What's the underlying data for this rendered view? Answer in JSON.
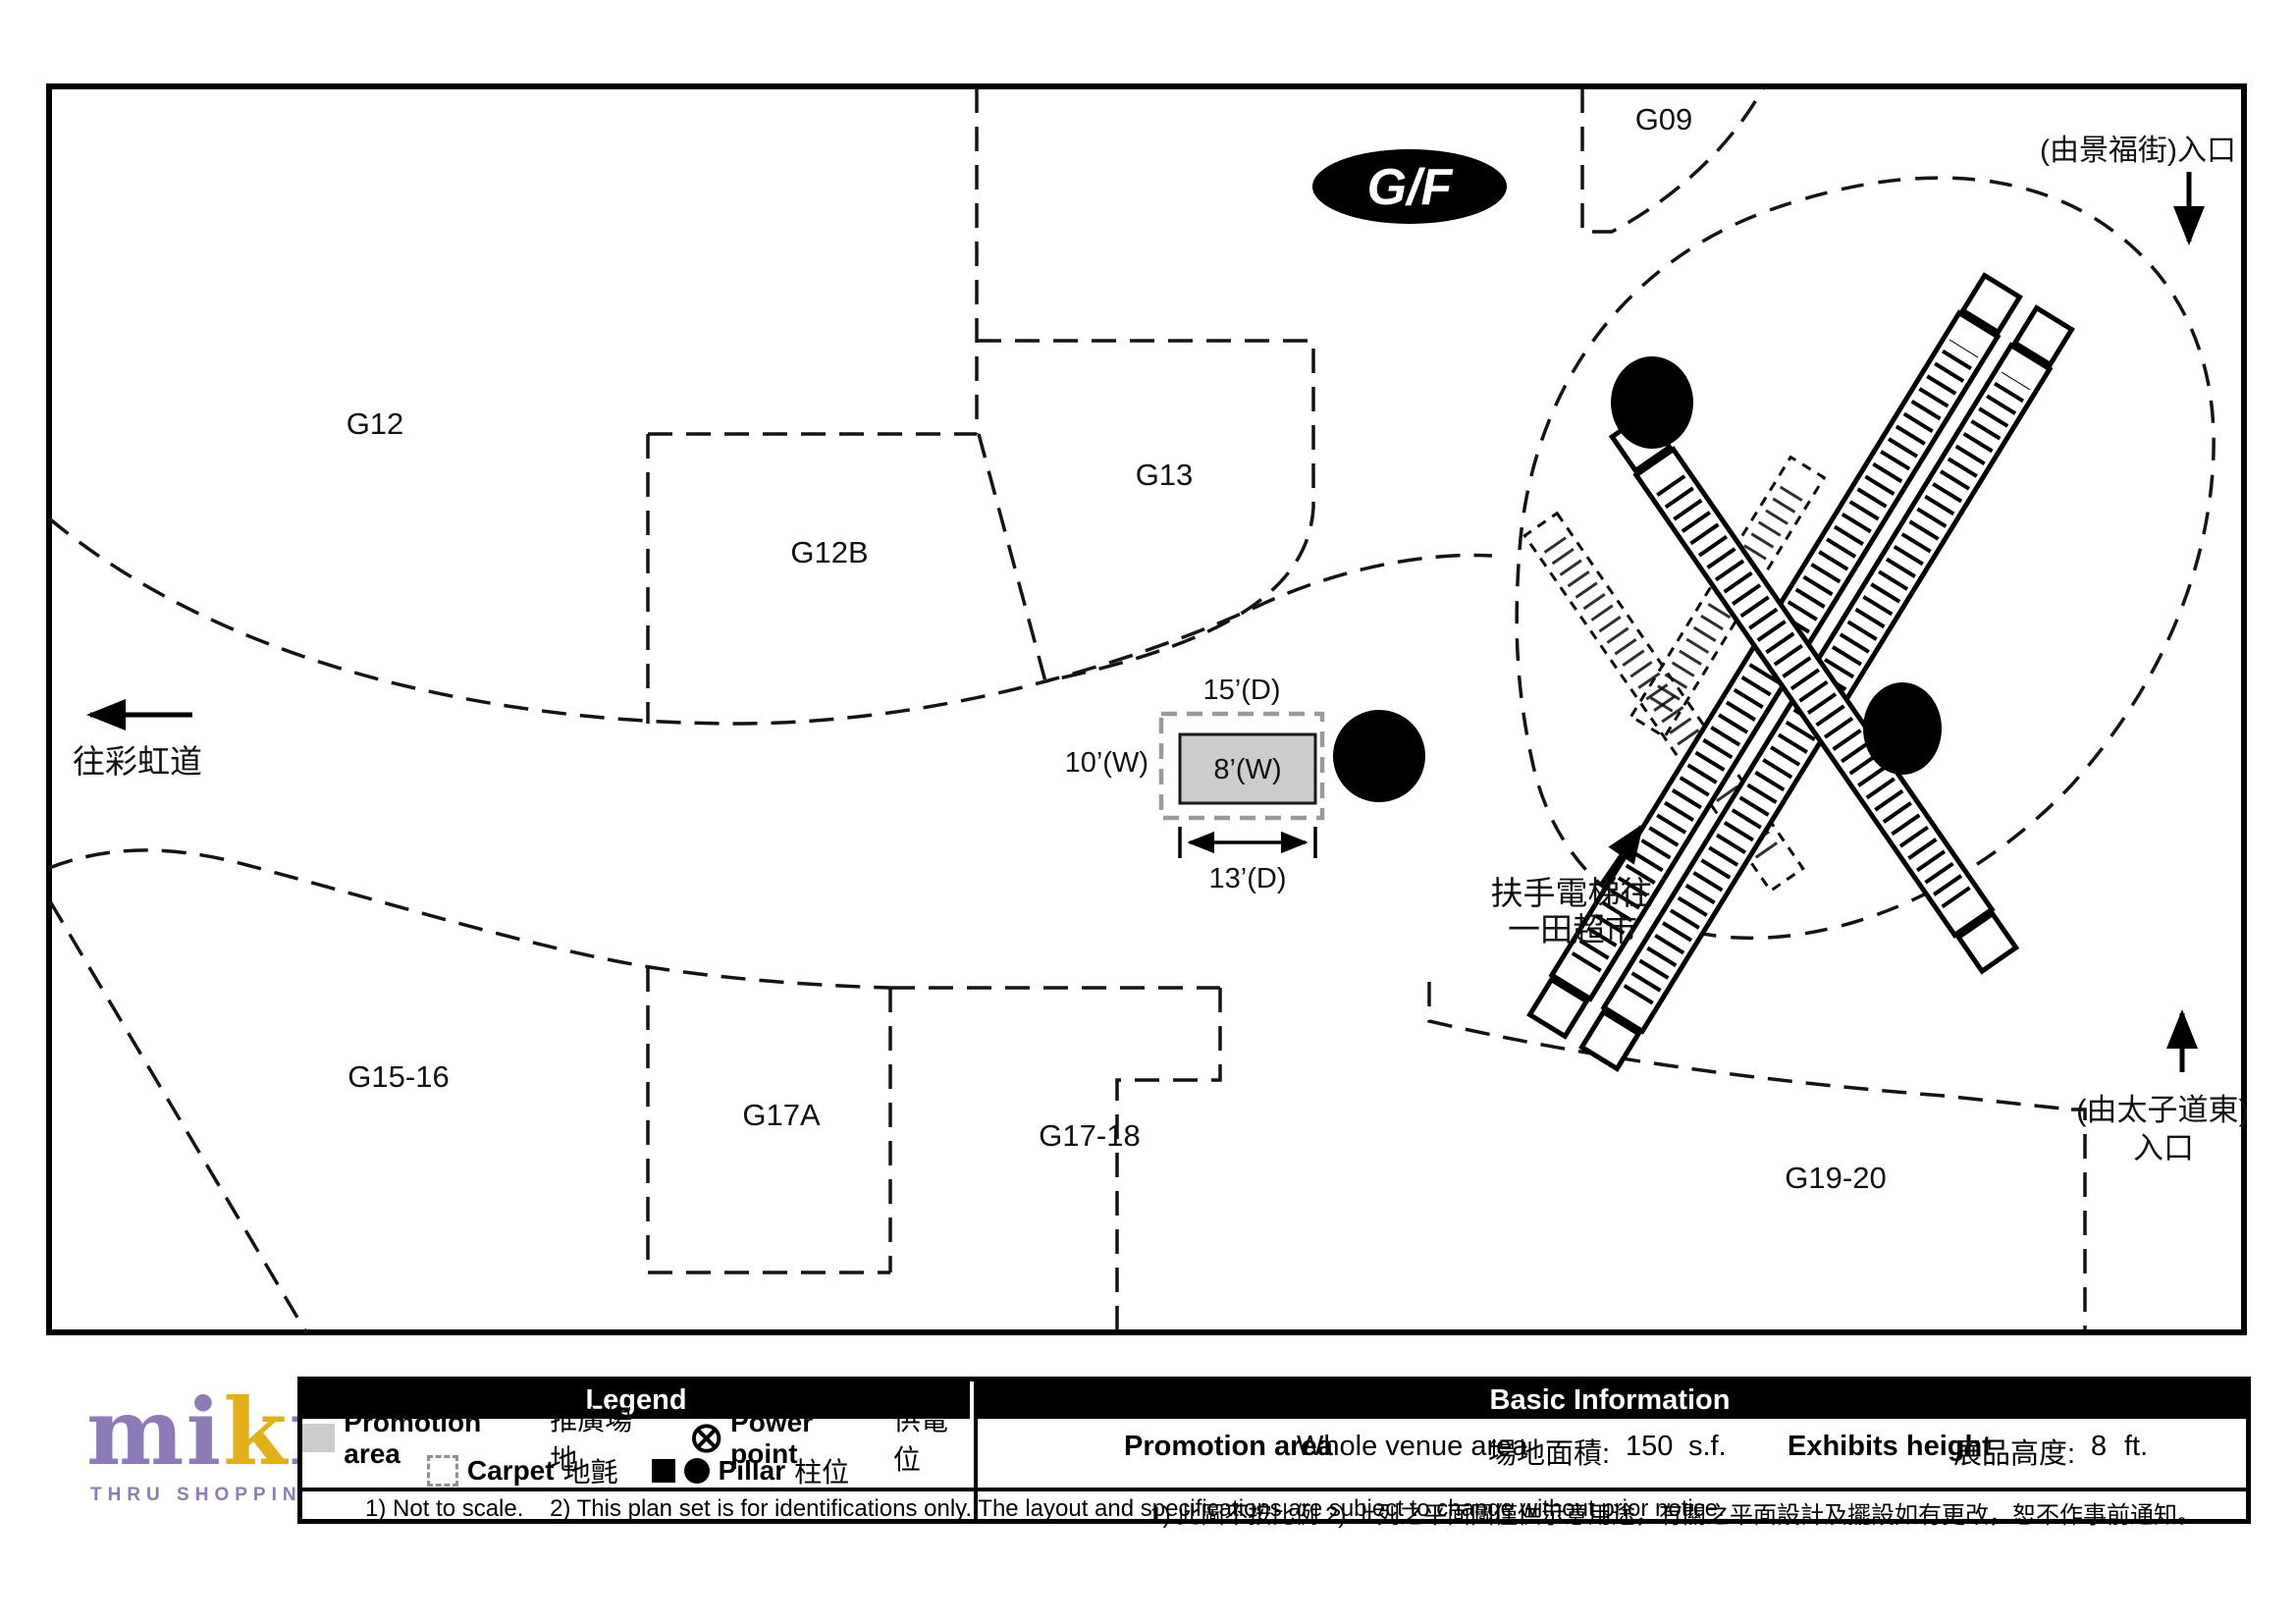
{
  "floor_badge": "G/F",
  "shops": {
    "g09": "G09",
    "g12": "G12",
    "g12b": "G12B",
    "g13": "G13",
    "g15_16": "G15-16",
    "g17a": "G17A",
    "g17_18": "G17-18",
    "g19_20": "G19-20"
  },
  "annotations": {
    "entrance_king_fuk": "(由景福街)入口",
    "to_choi_hung_road": "往彩虹道",
    "escalator_note_line1": "扶手電梯往",
    "escalator_note_line2": "一田超市",
    "entrance_prince_edward_line1": "(由太子道東)",
    "entrance_prince_edward_line2": "入口"
  },
  "promotion_area": {
    "depth_top": "15’(D)",
    "width_left": "10’(W)",
    "width_inner": "8’(W)",
    "depth_bottom": "13’(D)"
  },
  "legend": {
    "title": "Legend",
    "promotion_label": "Promotion area",
    "promotion_label_cn": "推廣場地",
    "carpet_label": "Carpet",
    "carpet_label_cn": "地氈",
    "power_point_label": "Power point",
    "power_point_label_cn": "供電位",
    "pillar_label": "Pillar",
    "pillar_label_cn": "柱位"
  },
  "basic_info": {
    "title": "Basic Information",
    "promotion_label": "Promotion area",
    "venue_value": "Whole venue area",
    "area_label": "場地面積:",
    "area_value": "150",
    "area_unit": "s.f.",
    "height_label": "Exhibits height",
    "height_label_cn": "展品高度:",
    "height_value": "8",
    "height_unit": "ft."
  },
  "notes": {
    "en": "1) Not to scale.    2) This plan set is for identifications only. The layout and specifications are subject to change without prior notice.",
    "cn": "1) 此圖不按比例 2) 上列之平面圖僅供示意用途，有關之平面設計及擺設如有更改，恕不作事前通知。"
  },
  "logo": {
    "letters": [
      "m",
      "i",
      "k",
      "i",
      "k",
      "i"
    ],
    "tagline": "THRU SHOPPING"
  },
  "colors": {
    "brand_purple": "#8d7bb8",
    "brand_gold": "#e3b117",
    "promo_fill": "#cccccc",
    "carpet_stroke": "#999999"
  }
}
